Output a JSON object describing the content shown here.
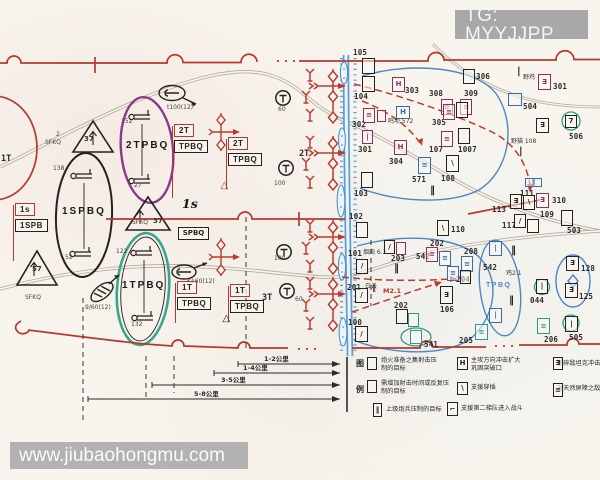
{
  "watermarks": {
    "tg": "TG: MYYJJPP",
    "site": "www.jiubaohongmu.com"
  },
  "colors": {
    "boundary_red": "#b5382e",
    "oval_purple": "#8a3a8a",
    "oval_teal": "#37a78c",
    "phase_blue": "#4c87c6",
    "unit_magenta": "#8f2f5f",
    "river_blue": "#5d9ed2",
    "road_gray": "#b3aa9c",
    "watermark_gray": "#aaaaaa",
    "ink_black": "#26201e"
  },
  "map": {
    "labels": [
      {
        "name": "oval-label-2tpbq",
        "t": "2TPBQ",
        "x": 126,
        "y": 141,
        "c": "big"
      },
      {
        "name": "oval-label-1spbq",
        "t": "1SPBQ",
        "x": 62,
        "y": 207,
        "c": "big"
      },
      {
        "name": "oval-label-1tpbq",
        "t": "1TPBQ",
        "x": 122,
        "y": 281,
        "c": "big"
      },
      {
        "name": "oval-label-tpbq-blue",
        "t": "TPBQ",
        "x": 486,
        "y": 282,
        "c": "bigblue"
      },
      {
        "name": "phase-label-1s",
        "t": "1s",
        "x": 182,
        "y": 198,
        "c": "serifbig"
      },
      {
        "name": "unit-label-2t",
        "t": "2T",
        "x": 299,
        "y": 150,
        "c": "n9"
      },
      {
        "name": "unit-label-3t",
        "t": "3T",
        "x": 262,
        "y": 294,
        "c": "n9"
      },
      {
        "name": "unit-label-1t",
        "t": "1T",
        "x": 1,
        "y": 155,
        "c": "n9"
      },
      {
        "name": "obs-label",
        "t": "60",
        "x": 278,
        "y": 107,
        "c": "t6"
      },
      {
        "name": "obs-label",
        "t": "100",
        "x": 274,
        "y": 181,
        "c": "t6"
      },
      {
        "name": "obs-label",
        "t": "100",
        "x": 274,
        "y": 256,
        "c": "t6"
      },
      {
        "name": "obs-label",
        "t": "60",
        "x": 295,
        "y": 297,
        "c": "t6"
      },
      {
        "name": "recon-label",
        "t": "t100(12)",
        "x": 167,
        "y": 105,
        "c": "t6"
      },
      {
        "name": "recon-label",
        "t": "K160(12)",
        "x": 187,
        "y": 279,
        "c": "t6"
      },
      {
        "name": "recon-label",
        "t": "9/60(12)",
        "x": 85,
        "y": 305,
        "c": "t6"
      },
      {
        "name": "sfkq-sup",
        "t": "2",
        "x": 56,
        "y": 132,
        "c": "t6"
      },
      {
        "name": "sfkq-label",
        "t": "SFKQ",
        "x": 45,
        "y": 140,
        "c": "t6"
      },
      {
        "name": "sfkq-label",
        "t": "SFKQ",
        "x": 132,
        "y": 220,
        "c": "t6"
      },
      {
        "name": "triangle-number",
        "t": "37",
        "x": 153,
        "y": 218,
        "c": "t7"
      },
      {
        "name": "triangle-number",
        "t": "37",
        "x": 84,
        "y": 136,
        "c": "t7"
      },
      {
        "name": "triangle-number",
        "t": "57",
        "x": 32,
        "y": 266,
        "c": "t7"
      },
      {
        "name": "sfkq-label",
        "t": "SFKQ",
        "x": 25,
        "y": 295,
        "c": "t6"
      },
      {
        "name": "arty-number",
        "t": "152",
        "x": 121,
        "y": 119,
        "c": "t6"
      },
      {
        "name": "arty-number",
        "t": "27",
        "x": 134,
        "y": 183,
        "c": "t6"
      },
      {
        "name": "arty-number",
        "t": "138",
        "x": 53,
        "y": 166,
        "c": "t6"
      },
      {
        "name": "arty-number",
        "t": "52",
        "x": 65,
        "y": 255,
        "c": "t6"
      },
      {
        "name": "arty-number",
        "t": "122",
        "x": 116,
        "y": 249,
        "c": "t6"
      },
      {
        "name": "arty-number",
        "t": "132",
        "x": 131,
        "y": 322,
        "c": "t6"
      },
      {
        "name": "place-label",
        "t": "鸣坝 572",
        "x": 388,
        "y": 119,
        "c": "cjk"
      },
      {
        "name": "place-label",
        "t": "野鸡",
        "x": 523,
        "y": 75,
        "c": "cjk"
      },
      {
        "name": "place-label",
        "t": "野猫 108",
        "x": 511,
        "y": 139,
        "c": "cjk"
      },
      {
        "name": "place-label",
        "t": "烟囱 6.2",
        "x": 363,
        "y": 250,
        "c": "cjk"
      },
      {
        "name": "place-label",
        "t": "白云",
        "x": 365,
        "y": 284,
        "c": "cjk"
      },
      {
        "name": "place-label",
        "t": "M2.1",
        "x": 383,
        "y": 288,
        "c": "t6r"
      },
      {
        "name": "place-label",
        "t": "鸡2.1",
        "x": 506,
        "y": 271,
        "c": "cjk"
      },
      {
        "name": "obstacle-bars",
        "t": "‖",
        "x": 430,
        "y": 186,
        "c": "bars"
      },
      {
        "name": "obstacle-bars",
        "t": "‖",
        "x": 394,
        "y": 264,
        "c": "bars"
      },
      {
        "name": "obstacle-bars",
        "t": "‖",
        "x": 511,
        "y": 246,
        "c": "bars"
      },
      {
        "name": "obstacle-bars",
        "t": "‖",
        "x": 509,
        "y": 296,
        "c": "bars"
      },
      {
        "name": "obstacle-bars",
        "t": "‖",
        "x": 372,
        "y": 284,
        "c": "bars-s"
      },
      {
        "name": "obstacle-bar",
        "t": "|",
        "x": 517,
        "y": 67,
        "c": "bars"
      },
      {
        "name": "obstacle-bar",
        "t": "|",
        "x": 519,
        "y": 147,
        "c": "bars"
      },
      {
        "name": "target-number",
        "t": "113",
        "x": 492,
        "y": 206,
        "c": "num"
      },
      {
        "name": "target-number",
        "t": "109",
        "x": 540,
        "y": 211,
        "c": "num"
      },
      {
        "name": "distance-label",
        "t": "1-2公里",
        "x": 264,
        "y": 356,
        "c": "dist"
      },
      {
        "name": "distance-label",
        "t": "1-4公里",
        "x": 243,
        "y": 365,
        "c": "dist"
      },
      {
        "name": "distance-label",
        "t": "3-5公里",
        "x": 221,
        "y": 377,
        "c": "dist"
      },
      {
        "name": "distance-label",
        "t": "5-8公里",
        "x": 194,
        "y": 391,
        "c": "dist"
      },
      {
        "name": "legend-title",
        "t": "图",
        "x": 356,
        "y": 360,
        "c": "legT"
      },
      {
        "name": "legend-title",
        "t": "例",
        "x": 356,
        "y": 386,
        "c": "legT"
      },
      {
        "name": "legend-text",
        "t": "炮火准备之集射击压",
        "x": 381,
        "y": 358,
        "c": "leg"
      },
      {
        "name": "legend-text",
        "t": "制的目标",
        "x": 381,
        "y": 366,
        "c": "leg"
      },
      {
        "name": "legend-text",
        "t": "主攻方向冲击扩大",
        "x": 471,
        "y": 358,
        "c": "leg"
      },
      {
        "name": "legend-text",
        "t": "巩固突破口",
        "x": 471,
        "y": 366,
        "c": "leg"
      },
      {
        "name": "legend-text",
        "t": "粉碎敌坦克冲击",
        "x": 557,
        "y": 361,
        "c": "leg"
      },
      {
        "name": "legend-text",
        "t": "需增加射击时间或反复压",
        "x": 381,
        "y": 381,
        "c": "leg"
      },
      {
        "name": "legend-text",
        "t": "制的目标",
        "x": 381,
        "y": 389,
        "c": "leg"
      },
      {
        "name": "legend-text",
        "t": "支援穿插",
        "x": 471,
        "y": 385,
        "c": "leg"
      },
      {
        "name": "legend-text",
        "t": "对天然屏障之敌",
        "x": 557,
        "y": 386,
        "c": "leg"
      },
      {
        "name": "legend-text",
        "t": "上级炮兵压制的目标",
        "x": 386,
        "y": 407,
        "c": "leg"
      },
      {
        "name": "legend-text",
        "t": "支援第二梯队进入战斗",
        "x": 461,
        "y": 406,
        "c": "leg"
      }
    ],
    "markers": [
      {
        "n": "105",
        "bx": 362,
        "by": 58,
        "bw": 13,
        "bh": 16,
        "s": "k",
        "tx": 353,
        "ty": 49
      },
      {
        "n": "104",
        "bx": 362,
        "by": 76,
        "bw": 13,
        "bh": 16,
        "s": "k",
        "tx": 354,
        "ty": 93
      },
      {
        "n": "303",
        "bx": 392,
        "by": 77,
        "bw": 13,
        "bh": 15,
        "s": "m",
        "g": "H",
        "tx": 405,
        "ty": 87
      },
      {
        "n": "306",
        "bx": 463,
        "by": 69,
        "bw": 12,
        "bh": 15,
        "s": "k",
        "tx": 476,
        "ty": 73
      },
      {
        "n": "308",
        "bx": 441,
        "by": 99,
        "bw": 12,
        "bh": 16,
        "s": "m",
        "g": "≡",
        "tx": 429,
        "ty": 90
      },
      {
        "n": "309",
        "bx": 460,
        "by": 99,
        "bw": 12,
        "bh": 16,
        "s": "m",
        "g": "≡",
        "tx": 464,
        "ty": 90
      },
      {
        "n": "302",
        "bx": 363,
        "by": 108,
        "bw": 12,
        "bh": 15,
        "s": "m",
        "g": "≡",
        "tx": 352,
        "ty": 121
      },
      {
        "bx": 377,
        "by": 110,
        "bw": 9,
        "bh": 12,
        "s": "m",
        "name": "box-302b"
      },
      {
        "bx": 396,
        "by": 106,
        "bw": 14,
        "bh": 13,
        "s": "b",
        "g": "H",
        "name": "box-572"
      },
      {
        "n": "305",
        "bx": 443,
        "by": 104,
        "bw": 12,
        "bh": 16,
        "s": "m",
        "g": "≡",
        "tx": 432,
        "ty": 119
      },
      {
        "bx": 456,
        "by": 102,
        "bw": 12,
        "bh": 16,
        "s": "k",
        "name": "box-307"
      },
      {
        "n": "301",
        "bx": 362,
        "by": 130,
        "bw": 11,
        "bh": 14,
        "s": "m",
        "g": "|",
        "tx": 358,
        "ty": 146
      },
      {
        "n": "304",
        "bx": 394,
        "by": 140,
        "bw": 13,
        "bh": 15,
        "s": "m",
        "g": "H",
        "tx": 389,
        "ty": 158
      },
      {
        "n": "107",
        "bx": 441,
        "by": 131,
        "bw": 12,
        "bh": 16,
        "s": "m",
        "g": "≡",
        "tx": 429,
        "ty": 146
      },
      {
        "n": "1007",
        "bx": 458,
        "by": 128,
        "bw": 12,
        "bh": 16,
        "s": "k",
        "tx": 458,
        "ty": 146
      },
      {
        "n": "571",
        "bx": 418,
        "by": 157,
        "bw": 13,
        "bh": 17,
        "s": "b",
        "g": "≡",
        "tx": 412,
        "ty": 176
      },
      {
        "n": "108",
        "bx": 446,
        "by": 155,
        "bw": 13,
        "bh": 17,
        "s": "k",
        "g": "\\",
        "tx": 441,
        "ty": 175
      },
      {
        "n": "103",
        "bx": 361,
        "by": 172,
        "bw": 12,
        "bh": 16,
        "s": "k",
        "tx": 354,
        "ty": 190
      },
      {
        "n": "102",
        "bx": 356,
        "by": 222,
        "bw": 12,
        "bh": 16,
        "s": "k",
        "tx": 349,
        "ty": 213
      },
      {
        "n": "110",
        "bx": 437,
        "by": 220,
        "bw": 12,
        "bh": 16,
        "s": "k",
        "g": "\\",
        "tx": 451,
        "ty": 226
      },
      {
        "n": "101",
        "bx": 356,
        "by": 259,
        "bw": 12,
        "bh": 15,
        "s": "k",
        "g": "/",
        "tx": 348,
        "ty": 250
      },
      {
        "n": "203",
        "bx": 384,
        "by": 240,
        "bw": 11,
        "bh": 14,
        "s": "k",
        "g": "/",
        "tx": 391,
        "ty": 255
      },
      {
        "bx": 396,
        "by": 242,
        "bw": 10,
        "bh": 13,
        "s": "m",
        "name": "box-203b"
      },
      {
        "n": "202",
        "bx": 426,
        "by": 247,
        "bw": 12,
        "bh": 15,
        "s": "m",
        "g": "≡",
        "tx": 430,
        "ty": 240
      },
      {
        "n": "542",
        "bx": 439,
        "by": 251,
        "bw": 12,
        "bh": 15,
        "s": "b",
        "g": "≡",
        "tx": 416,
        "ty": 253
      },
      {
        "n": "208",
        "bx": 461,
        "by": 256,
        "bw": 12,
        "bh": 16,
        "s": "b",
        "g": "≡",
        "tx": 464,
        "ty": 248
      },
      {
        "n": "204",
        "bx": 447,
        "by": 266,
        "bw": 12,
        "bh": 15,
        "s": "b",
        "g": "≡",
        "tx": 456,
        "ty": 276
      },
      {
        "bx": 460,
        "by": 270,
        "bw": 11,
        "bh": 14,
        "s": "k",
        "name": "box-204b"
      },
      {
        "n": "201",
        "bx": 355,
        "by": 288,
        "bw": 13,
        "bh": 15,
        "s": "k",
        "g": "/",
        "tx": 347,
        "ty": 284
      },
      {
        "n": "106",
        "bx": 440,
        "by": 286,
        "bw": 13,
        "bh": 18,
        "s": "k",
        "g": "∃",
        "tx": 440,
        "ty": 306
      },
      {
        "n": "202",
        "bx": 396,
        "by": 309,
        "bw": 12,
        "bh": 15,
        "s": "k",
        "tx": 394,
        "ty": 302,
        "name": "box-202b"
      },
      {
        "bx": 408,
        "by": 313,
        "bw": 11,
        "bh": 14,
        "s": "t",
        "name": "box-202c"
      },
      {
        "n": "100",
        "bx": 355,
        "by": 326,
        "bw": 13,
        "bh": 16,
        "s": "k",
        "g": "/",
        "tx": 348,
        "ty": 319
      },
      {
        "n": "541",
        "bx": 410,
        "by": 330,
        "bw": 12,
        "bh": 14,
        "s": "t",
        "tx": 424,
        "ty": 341
      },
      {
        "n": "205",
        "bx": 475,
        "by": 324,
        "bw": 13,
        "bh": 16,
        "s": "t",
        "g": "≡",
        "tx": 459,
        "ty": 337
      },
      {
        "n": "206",
        "bx": 537,
        "by": 318,
        "bw": 13,
        "bh": 16,
        "s": "t",
        "g": "≡",
        "tx": 544,
        "ty": 336
      },
      {
        "n": "505",
        "bx": 565,
        "by": 316,
        "bw": 13,
        "bh": 16,
        "s": "k",
        "g": "|",
        "tx": 569,
        "ty": 334
      },
      {
        "n": "503",
        "bx": 561,
        "by": 210,
        "bw": 12,
        "bh": 16,
        "s": "k",
        "tx": 567,
        "ty": 227
      },
      {
        "n": "310",
        "bx": 536,
        "by": 193,
        "bw": 13,
        "bh": 15,
        "s": "m",
        "g": "∃",
        "tx": 552,
        "ty": 197
      },
      {
        "bx": 510,
        "by": 194,
        "bw": 12,
        "bh": 15,
        "s": "k",
        "g": "∃",
        "name": "box-310b"
      },
      {
        "bx": 523,
        "by": 195,
        "bw": 12,
        "bh": 15,
        "s": "k",
        "g": "\\",
        "name": "box-310c"
      },
      {
        "n": "117",
        "bx": 514,
        "by": 214,
        "bw": 12,
        "bh": 14,
        "s": "k",
        "g": "/",
        "tx": 502,
        "ty": 222
      },
      {
        "bx": 527,
        "by": 219,
        "bw": 12,
        "bh": 14,
        "s": "k",
        "name": "box-117b"
      },
      {
        "n": "111",
        "bx": 525,
        "by": 178,
        "bw": 17,
        "bh": 9,
        "s": "b",
        "g": "‖",
        "tx": 520,
        "ty": 190
      },
      {
        "n": "301",
        "bx": 538,
        "by": 74,
        "bw": 13,
        "bh": 16,
        "s": "m",
        "g": "∃",
        "tx": 553,
        "ty": 83,
        "name": "box-301r"
      },
      {
        "n": "504",
        "bx": 508,
        "by": 93,
        "bw": 14,
        "bh": 13,
        "s": "b",
        "tx": 523,
        "ty": 103
      },
      {
        "n": "506",
        "bx": 565,
        "by": 115,
        "bw": 12,
        "bh": 13,
        "s": "k",
        "g": "7",
        "tx": 569,
        "ty": 133
      },
      {
        "bx": 536,
        "by": 118,
        "bw": 13,
        "bh": 15,
        "s": "k",
        "g": "∃",
        "name": "box-108r"
      },
      {
        "n": "128",
        "bx": 566,
        "by": 256,
        "bw": 13,
        "bh": 15,
        "s": "k",
        "g": "∃",
        "tx": 581,
        "ty": 265
      },
      {
        "n": "125",
        "bx": 565,
        "by": 283,
        "bw": 13,
        "bh": 15,
        "s": "k",
        "g": "∃",
        "tx": 579,
        "ty": 293
      },
      {
        "n": "044",
        "bx": 536,
        "by": 279,
        "bw": 12,
        "bh": 15,
        "s": "k",
        "g": "|",
        "tx": 530,
        "ty": 297
      },
      {
        "n": "542",
        "bx": 489,
        "by": 241,
        "bw": 13,
        "bh": 15,
        "s": "b",
        "g": "|",
        "tx": 483,
        "ty": 264,
        "name": "box-542b"
      },
      {
        "bx": 489,
        "by": 308,
        "bw": 13,
        "bh": 15,
        "s": "b",
        "g": "|",
        "name": "box-tpbq2"
      },
      {
        "bx": 178,
        "by": 227,
        "bw": 31,
        "bh": 13,
        "s": "k",
        "g": "SPBQ",
        "name": "spbq-box"
      },
      {
        "bx": 367,
        "by": 357,
        "bw": 10,
        "bh": 13,
        "s": "k",
        "name": "legend-sym-prep-target"
      },
      {
        "bx": 457,
        "by": 357,
        "bw": 11,
        "bh": 13,
        "s": "k",
        "g": "H",
        "name": "legend-sym-main-attack"
      },
      {
        "bx": 553,
        "by": 357,
        "bw": 10,
        "bh": 13,
        "s": "k",
        "g": "∃",
        "name": "legend-sym-crush-tanks"
      },
      {
        "bx": 367,
        "by": 380,
        "bw": 10,
        "bh": 13,
        "s": "k",
        "name": "legend-sym-repeat-target"
      },
      {
        "bx": 457,
        "by": 382,
        "bw": 11,
        "bh": 13,
        "s": "k",
        "g": "\\",
        "name": "legend-sym-infiltration"
      },
      {
        "bx": 553,
        "by": 383,
        "bw": 10,
        "bh": 14,
        "s": "k",
        "g": "≡",
        "name": "legend-sym-barrier"
      },
      {
        "bx": 373,
        "by": 403,
        "bw": 9,
        "bh": 14,
        "s": "k",
        "g": "‖",
        "name": "legend-sym-higher-arty"
      },
      {
        "bx": 447,
        "by": 402,
        "bw": 11,
        "bh": 14,
        "s": "k",
        "g": "⌐",
        "name": "legend-sym-second-echelon"
      }
    ],
    "flags": [
      {
        "top": "2T",
        "bottom": "TPBQ",
        "x": 172,
        "y": 124,
        "pole": 72
      },
      {
        "top": "2T",
        "bottom": "TPBQ",
        "x": 226,
        "y": 137,
        "pole": 50,
        "tri": "red"
      },
      {
        "top": "1T",
        "bottom": "TPBQ",
        "x": 175,
        "y": 281,
        "pole": 40
      },
      {
        "top": "1T",
        "bottom": "TPBQ",
        "x": 228,
        "y": 284,
        "pole": 36,
        "tri": "black"
      },
      {
        "top": "1s",
        "bottom": "1SPB",
        "x": 13,
        "y": 203,
        "pole": 56
      }
    ]
  }
}
